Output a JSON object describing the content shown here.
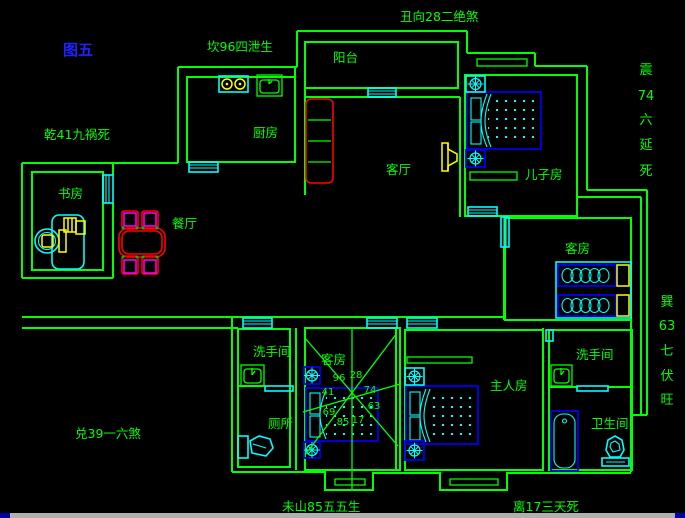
{
  "figure_label": "图五",
  "fengshui_labels": {
    "north": "坎96四泄生",
    "northeast": "丑向28二绝煞",
    "northwest": "乾41九祸死",
    "west": "兑39一六煞",
    "southwest": "未山85五五生",
    "south": "离17三天死",
    "east_vertical": [
      "震",
      "74",
      "六",
      "延",
      "死"
    ],
    "southeast_vertical": [
      "巽",
      "63",
      "七",
      "伏",
      "旺"
    ]
  },
  "rooms": {
    "balcony": "阳台",
    "kitchen": "厨房",
    "living_room": "客厅",
    "sons_room": "儿子房",
    "study": "书房",
    "dining_room": "餐厅",
    "guest_room_east": "客房",
    "guest_room_south": "客房",
    "washroom_west": "洗手间",
    "toilet": "厕所",
    "master_room": "主人房",
    "washroom_east": "洗手间",
    "bathroom": "卫生间"
  },
  "star_numbers": [
    "96",
    "28",
    "41",
    "74",
    "69",
    "63",
    "85",
    "17"
  ],
  "colors": {
    "background": "#000000",
    "wall": "#00ff00",
    "label_text": "#00ff00",
    "figure_label": "#2222ff",
    "fixture": "#00ffff",
    "bed": "#0000ee",
    "accent": "#ffff00",
    "table": "#ff0000",
    "chair": "#ff00ff",
    "statusbar": "#b0b0b0"
  }
}
